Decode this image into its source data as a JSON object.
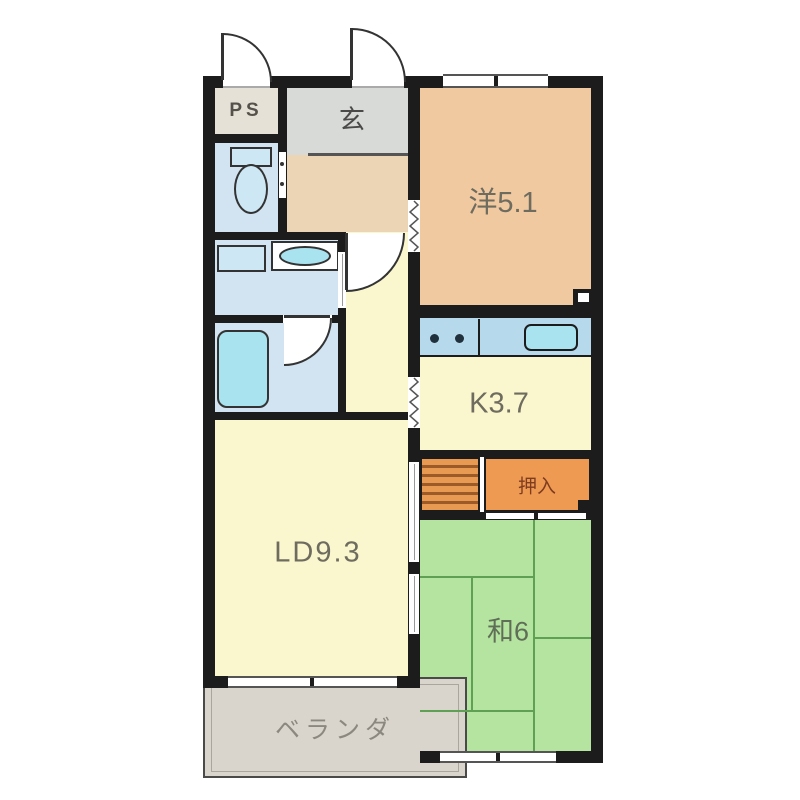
{
  "floorplan": {
    "rooms": {
      "ps": {
        "label": "PS"
      },
      "genkan": {
        "label": "玄"
      },
      "western": {
        "label": "洋5.1"
      },
      "kitchen": {
        "label": "K3.7"
      },
      "closet": {
        "label": "押入"
      },
      "living": {
        "label": "LD9.3"
      },
      "japanese": {
        "label": "和6"
      },
      "veranda": {
        "label": "ベランダ"
      }
    },
    "colors": {
      "wall": "#1c1c1c",
      "western_room": "#f1c9a1",
      "genkan_tile": "#d7dad7",
      "genkan_floor": "#ecd5b5",
      "shoe_cabinet": "#eba159",
      "ps": "#e6e1d7",
      "wet_room_blue": "#d2e3f1",
      "fixture_blue": "#cde7f5",
      "sink_cyan": "#a9e3ef",
      "counter_blue": "#b7d9ec",
      "pale_yellow": "#faf7cf",
      "closet_orange": "#ee9a52",
      "tatami_green": "#b5e4a1",
      "tatami_line": "#60a055",
      "veranda_gray": "#d9d5cd"
    }
  }
}
